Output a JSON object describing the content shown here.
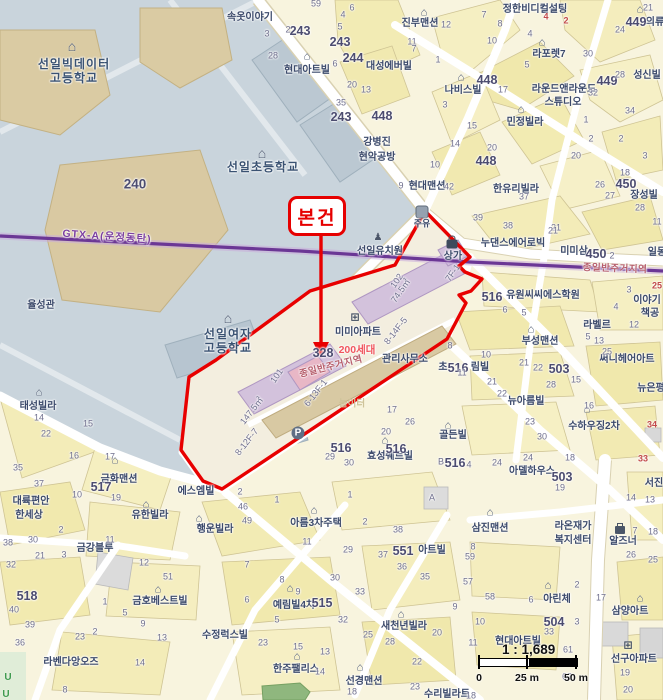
{
  "colors": {
    "land": "#F8F4DE",
    "campus": "#C9D4DC",
    "campus_building": "#DACBA3",
    "road": "#FFFFFF",
    "subject_outline": "#E80000",
    "rail_line": "#6B3795",
    "apartment_fill": "#D3C2DC",
    "apartment_pink": "#E8B7C6",
    "commercial_fill": "#D8C9A3",
    "park": "#8FB77E"
  },
  "callout": {
    "label": "본건"
  },
  "scalebar": {
    "ratio": "1 : 1,689",
    "tick0": "0",
    "tick25": "25 m",
    "tick50": "50 m"
  },
  "rail": {
    "label": "GTX-A(운정동탄)"
  },
  "zoning": {
    "label": "종일반주거지역"
  },
  "subject": {
    "complex": "미미아파트",
    "households": "200세대",
    "office": "관리사무소",
    "building_a": "101",
    "building_b": "102",
    "area_a": "147.5㎡",
    "area_b": "74.5㎡",
    "lot": "328",
    "units": [
      "8-14F-5",
      "6-13F-1",
      "8-12F-7",
      "7F-1"
    ]
  },
  "labels": [
    {
      "t": "선일빅데이터",
      "x": 74,
      "y": 64,
      "k": "sch",
      "n": "school-label"
    },
    {
      "t": "고등학교",
      "x": 74,
      "y": 78,
      "k": "sch",
      "n": "school-label"
    },
    {
      "t": "선일초등학교",
      "x": 263,
      "y": 167,
      "k": "sch",
      "n": "school-label"
    },
    {
      "t": "선일여자",
      "x": 228,
      "y": 334,
      "k": "sch",
      "n": "school-label"
    },
    {
      "t": "고등학교",
      "x": 228,
      "y": 348,
      "k": "sch",
      "n": "school-label"
    },
    {
      "t": "율성관",
      "x": 41,
      "y": 306
    },
    {
      "t": "속옷이야기",
      "x": 250,
      "y": 18
    },
    {
      "t": "현대아트빌",
      "x": 307,
      "y": 71
    },
    {
      "t": "진부맨션",
      "x": 420,
      "y": 24
    },
    {
      "t": "정한비디컬설팅",
      "x": 535,
      "y": 10
    },
    {
      "t": "대성에버빌",
      "x": 389,
      "y": 67
    },
    {
      "t": "나비스빌",
      "x": 463,
      "y": 91
    },
    {
      "t": "라포렛7",
      "x": 549,
      "y": 55
    },
    {
      "t": "라운드앤라운드",
      "x": 564,
      "y": 90
    },
    {
      "t": "스튜디오",
      "x": 563,
      "y": 103
    },
    {
      "t": "성신빌",
      "x": 647,
      "y": 76
    },
    {
      "t": "의류",
      "x": 655,
      "y": 23
    },
    {
      "t": "민정빌라",
      "x": 525,
      "y": 123
    },
    {
      "t": "강병진",
      "x": 377,
      "y": 143
    },
    {
      "t": "현악공방",
      "x": 377,
      "y": 158
    },
    {
      "t": "장성빌",
      "x": 644,
      "y": 196
    },
    {
      "t": "현대맨션",
      "x": 427,
      "y": 187
    },
    {
      "t": "한유리빌라",
      "x": 516,
      "y": 190
    },
    {
      "t": "누댄스에어로빅",
      "x": 513,
      "y": 244
    },
    {
      "t": "미미삼",
      "x": 574,
      "y": 252
    },
    {
      "t": "일동",
      "x": 657,
      "y": 253
    },
    {
      "t": "선일유치원",
      "x": 380,
      "y": 252
    },
    {
      "t": "상가",
      "x": 453,
      "y": 257
    },
    {
      "t": "주유",
      "x": 422,
      "y": 224,
      "s": 9
    },
    {
      "t": "유원씨씨에스학원",
      "x": 543,
      "y": 296
    },
    {
      "t": "이야기",
      "x": 647,
      "y": 301
    },
    {
      "t": "책공",
      "x": 650,
      "y": 314
    },
    {
      "t": "라벨르",
      "x": 597,
      "y": 326
    },
    {
      "t": "부성맨션",
      "x": 540,
      "y": 342
    },
    {
      "t": "초",
      "x": 443,
      "y": 368
    },
    {
      "t": "림빌",
      "x": 480,
      "y": 368
    },
    {
      "t": "써니헤어아트",
      "x": 627,
      "y": 360
    },
    {
      "t": "뉴은평",
      "x": 651,
      "y": 389
    },
    {
      "t": "뉴아름빌",
      "x": 526,
      "y": 402
    },
    {
      "t": "수하우징2차",
      "x": 594,
      "y": 427
    },
    {
      "t": "골든빌",
      "x": 453,
      "y": 436
    },
    {
      "t": "아델하우스",
      "x": 532,
      "y": 472
    },
    {
      "t": "알즈너",
      "x": 623,
      "y": 542
    },
    {
      "t": "라온재가",
      "x": 573,
      "y": 527
    },
    {
      "t": "복지센터",
      "x": 573,
      "y": 541
    },
    {
      "t": "서진",
      "x": 654,
      "y": 484
    },
    {
      "t": "삼진맨션",
      "x": 490,
      "y": 529
    },
    {
      "t": "아린체",
      "x": 557,
      "y": 600
    },
    {
      "t": "삼양아트",
      "x": 630,
      "y": 612
    },
    {
      "t": "현대아트빌",
      "x": 518,
      "y": 642
    },
    {
      "t": "선구아파트",
      "x": 634,
      "y": 660
    },
    {
      "t": "수리빌라트",
      "x": 447,
      "y": 695
    },
    {
      "t": "새천년빌라",
      "x": 404,
      "y": 627
    },
    {
      "t": "아트빌",
      "x": 432,
      "y": 551
    },
    {
      "t": "아름3차주택",
      "x": 316,
      "y": 524
    },
    {
      "t": "예림빌4차",
      "x": 294,
      "y": 606
    },
    {
      "t": "에스엠빌",
      "x": 196,
      "y": 492
    },
    {
      "t": "행운빌라",
      "x": 215,
      "y": 530
    },
    {
      "t": "유한빌라",
      "x": 150,
      "y": 516
    },
    {
      "t": "태성빌라",
      "x": 38,
      "y": 407
    },
    {
      "t": "금화맨션",
      "x": 119,
      "y": 480
    },
    {
      "t": "대륙편안",
      "x": 31,
      "y": 502
    },
    {
      "t": "한세상",
      "x": 29,
      "y": 516
    },
    {
      "t": "금강블루",
      "x": 95,
      "y": 549
    },
    {
      "t": "금호베스트빌",
      "x": 160,
      "y": 602
    },
    {
      "t": "수정럭스빌",
      "x": 225,
      "y": 636
    },
    {
      "t": "라벤다앙오즈",
      "x": 71,
      "y": 663
    },
    {
      "t": "한주팰리스",
      "x": 296,
      "y": 670
    },
    {
      "t": "선경맨션",
      "x": 364,
      "y": 682
    },
    {
      "t": "효성쉐르빌",
      "x": 390,
      "y": 457
    },
    {
      "t": "미미아파트",
      "x": 358,
      "y": 333
    },
    {
      "t": "관리사무소",
      "x": 405,
      "y": 360
    },
    {
      "t": "놀이터",
      "x": 352,
      "y": 404,
      "k": "pale",
      "n": "poi-label"
    },
    {
      "t": "GTX-A(운정동탄)",
      "x": 107,
      "y": 237,
      "k": "gtx",
      "r": 4,
      "n": "rail-line-label"
    },
    {
      "t": "종일반주거지역",
      "x": 615,
      "y": 269,
      "k": "zon",
      "r": 2,
      "n": "zoning-label"
    },
    {
      "t": "종일반주거지역",
      "x": 331,
      "y": 367,
      "k": "zon",
      "r": -14,
      "n": "zoning-label"
    },
    {
      "t": "200세대",
      "x": 357,
      "y": 350,
      "k": "red",
      "n": "annotation-label"
    },
    {
      "t": "102",
      "x": 397,
      "y": 281,
      "k": "num",
      "r": -55,
      "n": "building-number"
    },
    {
      "t": "74.5㎡",
      "x": 401,
      "y": 291,
      "k": "num",
      "r": -55,
      "n": "area-label"
    },
    {
      "t": "8-14F-5",
      "x": 396,
      "y": 331,
      "k": "num",
      "r": -52,
      "n": "unit-label"
    },
    {
      "t": "101",
      "x": 277,
      "y": 376,
      "k": "num",
      "r": -55,
      "n": "building-number"
    },
    {
      "t": "147.5㎡",
      "x": 252,
      "y": 411,
      "k": "num",
      "r": -52,
      "n": "area-label"
    },
    {
      "t": "6-13F-1",
      "x": 316,
      "y": 393,
      "k": "num",
      "r": -52,
      "n": "unit-label"
    },
    {
      "t": "8-12F-7",
      "x": 247,
      "y": 442,
      "k": "num",
      "r": -52,
      "n": "unit-label"
    },
    {
      "t": "7F-1",
      "x": 453,
      "y": 273,
      "k": "num",
      "r": -55,
      "n": "unit-label"
    },
    {
      "t": "240",
      "x": 135,
      "y": 184,
      "k": "bold",
      "s": 13.5,
      "n": "parcel-number-bold"
    },
    {
      "t": "243",
      "x": 300,
      "y": 31,
      "k": "bold",
      "n": "parcel-number-bold"
    },
    {
      "t": "243",
      "x": 340,
      "y": 42,
      "k": "bold",
      "n": "parcel-number-bold"
    },
    {
      "t": "243",
      "x": 341,
      "y": 117,
      "k": "bold",
      "n": "parcel-number-bold"
    },
    {
      "t": "244",
      "x": 353,
      "y": 58,
      "k": "bold",
      "n": "parcel-number-bold"
    },
    {
      "t": "448",
      "x": 382,
      "y": 116,
      "k": "bold",
      "n": "parcel-number-bold"
    },
    {
      "t": "448",
      "x": 487,
      "y": 80,
      "k": "bold",
      "n": "parcel-number-bold"
    },
    {
      "t": "448",
      "x": 486,
      "y": 161,
      "k": "bold",
      "n": "parcel-number-bold"
    },
    {
      "t": "449",
      "x": 607,
      "y": 81,
      "k": "bold",
      "n": "parcel-number-bold"
    },
    {
      "t": "449",
      "x": 636,
      "y": 22,
      "k": "bold",
      "n": "parcel-number-bold"
    },
    {
      "t": "450",
      "x": 626,
      "y": 184,
      "k": "bold",
      "n": "parcel-number-bold"
    },
    {
      "t": "450",
      "x": 596,
      "y": 254,
      "k": "bold",
      "n": "parcel-number-bold"
    },
    {
      "t": "517",
      "x": 101,
      "y": 487,
      "k": "bold",
      "n": "parcel-number-bold"
    },
    {
      "t": "518",
      "x": 27,
      "y": 596,
      "k": "bold",
      "n": "parcel-number-bold"
    },
    {
      "t": "515",
      "x": 322,
      "y": 603,
      "k": "bold",
      "n": "parcel-number-bold"
    },
    {
      "t": "516",
      "x": 492,
      "y": 297,
      "k": "bold",
      "n": "parcel-number-bold"
    },
    {
      "t": "516",
      "x": 458,
      "y": 368,
      "k": "bold",
      "n": "parcel-number-bold"
    },
    {
      "t": "516",
      "x": 341,
      "y": 448,
      "k": "bold",
      "n": "parcel-number-bold"
    },
    {
      "t": "516",
      "x": 396,
      "y": 449,
      "k": "bold",
      "n": "parcel-number-bold"
    },
    {
      "t": "516",
      "x": 455,
      "y": 463,
      "k": "bold",
      "n": "parcel-number-bold"
    },
    {
      "t": "503",
      "x": 559,
      "y": 369,
      "k": "bold",
      "n": "parcel-number-bold"
    },
    {
      "t": "503",
      "x": 562,
      "y": 477,
      "k": "bold",
      "n": "parcel-number-bold"
    },
    {
      "t": "504",
      "x": 554,
      "y": 622,
      "k": "bold",
      "n": "parcel-number-bold"
    },
    {
      "t": "551",
      "x": 403,
      "y": 551,
      "k": "bold",
      "n": "parcel-number-bold"
    },
    {
      "t": "328",
      "x": 323,
      "y": 353,
      "k": "bold",
      "n": "parcel-number-bold"
    }
  ],
  "numbers": [
    [
      59,
      316,
      4
    ],
    [
      2,
      288,
      30
    ],
    [
      3,
      267,
      34
    ],
    [
      28,
      273,
      56
    ],
    [
      4,
      343,
      15
    ],
    [
      6,
      352,
      8
    ],
    [
      5,
      340,
      27
    ],
    [
      6,
      335,
      64
    ],
    [
      20,
      352,
      85
    ],
    [
      13,
      366,
      90
    ],
    [
      35,
      341,
      103
    ],
    [
      11,
      412,
      42
    ],
    [
      12,
      446,
      25
    ],
    [
      1,
      438,
      60
    ],
    [
      7,
      414,
      49
    ],
    [
      3,
      445,
      105
    ],
    [
      15,
      472,
      126
    ],
    [
      14,
      455,
      144
    ],
    [
      20,
      492,
      148
    ],
    [
      10,
      435,
      165
    ],
    [
      17,
      503,
      90
    ],
    [
      5,
      527,
      65
    ],
    [
      8,
      500,
      24
    ],
    [
      7,
      484,
      15
    ],
    [
      4,
      530,
      34
    ],
    [
      10,
      492,
      41
    ],
    [
      30,
      588,
      54
    ],
    [
      28,
      620,
      75
    ],
    [
      32,
      593,
      93
    ],
    [
      34,
      630,
      111
    ],
    [
      24,
      620,
      30
    ],
    [
      21,
      648,
      8
    ],
    [
      1,
      586,
      120
    ],
    [
      2,
      591,
      139
    ],
    [
      2,
      621,
      139
    ],
    [
      3,
      645,
      156
    ],
    [
      18,
      625,
      173
    ],
    [
      20,
      576,
      156
    ],
    [
      26,
      600,
      185
    ],
    [
      27,
      610,
      196
    ],
    [
      28,
      640,
      208
    ],
    [
      11,
      657,
      222
    ],
    [
      21,
      556,
      228
    ],
    [
      37,
      524,
      197
    ],
    [
      42,
      449,
      187
    ],
    [
      9,
      401,
      186
    ],
    [
      39,
      478,
      218
    ],
    [
      38,
      508,
      226
    ],
    [
      21,
      553,
      231
    ],
    [
      2,
      612,
      256
    ],
    [
      6,
      505,
      310
    ],
    [
      5,
      524,
      313
    ],
    [
      3,
      629,
      290
    ],
    [
      4,
      616,
      307
    ],
    [
      12,
      634,
      325
    ],
    [
      5,
      588,
      337
    ],
    [
      13,
      599,
      341
    ],
    [
      25,
      607,
      352
    ],
    [
      8,
      450,
      346
    ],
    [
      10,
      486,
      355
    ],
    [
      11,
      462,
      373
    ],
    [
      21,
      492,
      382
    ],
    [
      22,
      502,
      394
    ],
    [
      15,
      576,
      380
    ],
    [
      28,
      551,
      385
    ],
    [
      21,
      524,
      363
    ],
    [
      22,
      538,
      368
    ],
    [
      16,
      589,
      406
    ],
    [
      23,
      530,
      422
    ],
    [
      30,
      542,
      437
    ],
    [
      24,
      528,
      458
    ],
    [
      18,
      570,
      458
    ],
    [
      19,
      560,
      488
    ],
    [
      17,
      392,
      410
    ],
    [
      26,
      410,
      422
    ],
    [
      20,
      386,
      432
    ],
    [
      29,
      330,
      457
    ],
    [
      30,
      349,
      463
    ],
    [
      "B",
      441,
      462
    ],
    [
      4,
      469,
      465
    ],
    [
      24,
      497,
      463
    ],
    [
      14,
      39,
      418
    ],
    [
      15,
      88,
      424
    ],
    [
      22,
      46,
      434
    ],
    [
      16,
      74,
      456
    ],
    [
      35,
      18,
      468
    ],
    [
      37,
      39,
      484
    ],
    [
      17,
      110,
      457
    ],
    [
      19,
      116,
      498
    ],
    [
      10,
      77,
      495
    ],
    [
      2,
      240,
      492
    ],
    [
      46,
      243,
      507
    ],
    [
      49,
      247,
      521
    ],
    [
      1,
      277,
      500
    ],
    [
      38,
      8,
      543
    ],
    [
      30,
      33,
      540
    ],
    [
      2,
      61,
      530
    ],
    [
      21,
      40,
      556
    ],
    [
      3,
      64,
      555
    ],
    [
      32,
      11,
      565
    ],
    [
      11,
      110,
      540
    ],
    [
      12,
      144,
      563
    ],
    [
      51,
      168,
      577
    ],
    [
      40,
      14,
      610
    ],
    [
      39,
      30,
      625
    ],
    [
      36,
      20,
      643
    ],
    [
      1,
      105,
      602
    ],
    [
      5,
      125,
      613
    ],
    [
      9,
      143,
      624
    ],
    [
      13,
      162,
      638
    ],
    [
      2,
      95,
      632
    ],
    [
      23,
      80,
      637
    ],
    [
      14,
      140,
      663
    ],
    [
      8,
      65,
      690
    ],
    [
      7,
      247,
      565
    ],
    [
      8,
      282,
      580
    ],
    [
      9,
      298,
      592
    ],
    [
      6,
      247,
      600
    ],
    [
      5,
      277,
      620
    ],
    [
      23,
      263,
      643
    ],
    [
      15,
      298,
      647
    ],
    [
      13,
      325,
      652
    ],
    [
      14,
      320,
      672
    ],
    [
      1,
      350,
      495
    ],
    [
      2,
      365,
      522
    ],
    [
      11,
      307,
      542
    ],
    [
      29,
      348,
      550
    ],
    [
      30,
      335,
      578
    ],
    [
      33,
      360,
      592
    ],
    [
      32,
      343,
      620
    ],
    [
      25,
      368,
      635
    ],
    [
      28,
      390,
      642
    ],
    [
      38,
      398,
      530
    ],
    [
      37,
      383,
      555
    ],
    [
      36,
      402,
      567
    ],
    [
      35,
      425,
      577
    ],
    [
      20,
      437,
      633
    ],
    [
      22,
      417,
      662
    ],
    [
      23,
      415,
      687
    ],
    [
      59,
      470,
      557
    ],
    [
      57,
      468,
      582
    ],
    [
      58,
      490,
      597
    ],
    [
      9,
      455,
      607
    ],
    [
      10,
      480,
      622
    ],
    [
      11,
      473,
      643
    ],
    [
      8,
      473,
      547
    ],
    [
      61,
      568,
      650
    ],
    [
      62,
      567,
      677
    ],
    [
      33,
      549,
      632
    ],
    [
      3,
      577,
      622
    ],
    [
      2,
      577,
      585
    ],
    [
      6,
      531,
      600
    ],
    [
      17,
      601,
      598
    ],
    [
      19,
      625,
      673
    ],
    [
      20,
      628,
      690
    ],
    [
      14,
      631,
      498
    ],
    [
      13,
      650,
      500
    ],
    [
      7,
      635,
      531
    ],
    [
      18,
      653,
      532
    ],
    [
      26,
      631,
      555
    ],
    [
      25,
      653,
      560
    ],
    [
      "A",
      432,
      498
    ],
    [
      18,
      471,
      696
    ],
    [
      18,
      352,
      692
    ],
    [
      25,
      657,
      286,
      "r"
    ],
    [
      34,
      652,
      425,
      "r"
    ],
    [
      33,
      643,
      459,
      "r"
    ],
    [
      4,
      546,
      17,
      "r"
    ],
    [
      2,
      566,
      21,
      "r"
    ]
  ],
  "icon_glyphs": {
    "house": "⌂",
    "school": "⌂",
    "apartment": "⊞",
    "person": "♟",
    "parking": "P",
    "pump": "",
    "shop": "",
    "briefcase": "",
    "green-u": "U"
  },
  "icons": [
    {
      "t": "school",
      "x": 72,
      "y": 46
    },
    {
      "t": "school",
      "x": 262,
      "y": 153
    },
    {
      "t": "school",
      "x": 228,
      "y": 318
    },
    {
      "t": "person",
      "x": 378,
      "y": 238
    },
    {
      "t": "shop",
      "x": 452,
      "y": 244
    },
    {
      "t": "pump",
      "x": 422,
      "y": 212
    },
    {
      "t": "parking",
      "x": 298,
      "y": 433
    },
    {
      "t": "apartment",
      "x": 355,
      "y": 318
    },
    {
      "t": "apartment",
      "x": 628,
      "y": 646
    },
    {
      "t": "briefcase",
      "x": 620,
      "y": 530
    },
    {
      "t": "house",
      "x": 424,
      "y": 13
    },
    {
      "t": "house",
      "x": 307,
      "y": 57
    },
    {
      "t": "house",
      "x": 461,
      "y": 78
    },
    {
      "t": "house",
      "x": 542,
      "y": 43
    },
    {
      "t": "house",
      "x": 640,
      "y": 10
    },
    {
      "t": "house",
      "x": 521,
      "y": 110
    },
    {
      "t": "house",
      "x": 531,
      "y": 330
    },
    {
      "t": "house",
      "x": 587,
      "y": 410
    },
    {
      "t": "house",
      "x": 448,
      "y": 426
    },
    {
      "t": "house",
      "x": 39,
      "y": 393
    },
    {
      "t": "house",
      "x": 115,
      "y": 461
    },
    {
      "t": "house",
      "x": 146,
      "y": 505
    },
    {
      "t": "house",
      "x": 199,
      "y": 519
    },
    {
      "t": "house",
      "x": 314,
      "y": 511
    },
    {
      "t": "house",
      "x": 158,
      "y": 590
    },
    {
      "t": "house",
      "x": 297,
      "y": 657
    },
    {
      "t": "house",
      "x": 360,
      "y": 668
    },
    {
      "t": "house",
      "x": 401,
      "y": 615
    },
    {
      "t": "house",
      "x": 548,
      "y": 586
    },
    {
      "t": "house",
      "x": 640,
      "y": 599
    },
    {
      "t": "house",
      "x": 490,
      "y": 513
    },
    {
      "t": "house",
      "x": 290,
      "y": 589
    },
    {
      "t": "house",
      "x": 385,
      "y": 441
    },
    {
      "t": "green-u",
      "x": 8,
      "y": 678
    },
    {
      "t": "green-u",
      "x": 6,
      "y": 695
    }
  ]
}
